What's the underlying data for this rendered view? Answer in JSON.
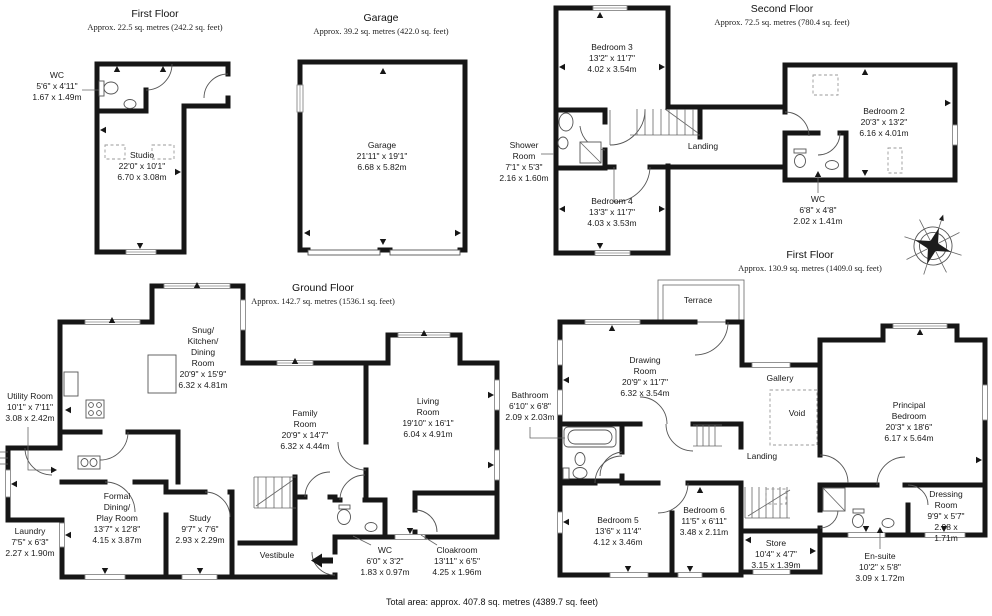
{
  "colors": {
    "wall": "#161616",
    "background": "#ffffff"
  },
  "headers": {
    "annex_first_floor": {
      "title": "First Floor",
      "subtitle": "Approx. 22.5 sq. metres (242.2 sq. feet)"
    },
    "garage": {
      "title": "Garage",
      "subtitle": "Approx. 39.2 sq. metres (422.0 sq. feet)"
    },
    "second_floor": {
      "title": "Second Floor",
      "subtitle": "Approx. 72.5 sq. metres (780.4 sq. feet)"
    },
    "ground_floor": {
      "title": "Ground Floor",
      "subtitle": "Approx. 142.7 sq. metres (1536.1 sq. feet)"
    },
    "first_floor": {
      "title": "First Floor",
      "subtitle": "Approx. 130.9 sq. metres (1409.0 sq. feet)"
    }
  },
  "rooms": {
    "wc_annex": {
      "name": "WC",
      "imperial": "5'6\" x 4'11\"",
      "metric": "1.67 x 1.49m"
    },
    "studio": {
      "name": "Studio",
      "imperial": "22'0\" x 10'1\"",
      "metric": "6.70 x 3.08m"
    },
    "garage_room": {
      "name": "Garage",
      "imperial": "21'11\" x 19'1\"",
      "metric": "6.68 x 5.82m"
    },
    "bedroom3": {
      "name": "Bedroom 3",
      "imperial": "13'2\" x 11'7\"",
      "metric": "4.02 x 3.54m"
    },
    "shower_room": {
      "name": "Shower\nRoom",
      "imperial": "7'1\" x 5'3\"",
      "metric": "2.16 x 1.60m"
    },
    "bedroom4": {
      "name": "Bedroom 4",
      "imperial": "13'3\" x 11'7\"",
      "metric": "4.03 x 3.53m"
    },
    "landing_second": {
      "name": "Landing"
    },
    "bedroom2": {
      "name": "Bedroom 2",
      "imperial": "20'3\" x 13'2\"",
      "metric": "6.16 x 4.01m"
    },
    "wc_second": {
      "name": "WC",
      "imperial": "6'8\" x 4'8\"",
      "metric": "2.02 x 1.41m"
    },
    "utility": {
      "name": "Utility Room",
      "imperial": "10'1\" x 7'11\"",
      "metric": "3.08 x 2.42m"
    },
    "snug_kitchen_dining": {
      "name": "Snug/\nKitchen/\nDining\nRoom",
      "imperial": "20'9\" x 15'9\"",
      "metric": "6.32 x 4.81m"
    },
    "family_room": {
      "name": "Family\nRoom",
      "imperial": "20'9\" x 14'7\"",
      "metric": "6.32 x 4.44m"
    },
    "living_room": {
      "name": "Living\nRoom",
      "imperial": "19'10\" x 16'1\"",
      "metric": "6.04 x 4.91m"
    },
    "formal_dining": {
      "name": "Formal\nDining/\nPlay Room",
      "imperial": "13'7\" x 12'8\"",
      "metric": "4.15 x 3.87m"
    },
    "laundry": {
      "name": "Laundry",
      "imperial": "7'5\" x 6'3\"",
      "metric": "2.27 x 1.90m"
    },
    "study": {
      "name": "Study",
      "imperial": "9'7\" x 7'6\"",
      "metric": "2.93 x 2.29m"
    },
    "vestibule": {
      "name": "Vestibule"
    },
    "wc_ground": {
      "name": "WC",
      "imperial": "6'0\" x 3'2\"",
      "metric": "1.83 x 0.97m"
    },
    "cloakroom": {
      "name": "Cloakroom",
      "imperial": "13'11\" x 6'5\"",
      "metric": "4.25 x 1.96m"
    },
    "terrace": {
      "name": "Terrace"
    },
    "drawing_room": {
      "name": "Drawing\nRoom",
      "imperial": "20'9\" x 11'7\"",
      "metric": "6.32 x 3.54m"
    },
    "bathroom": {
      "name": "Bathroom",
      "imperial": "6'10\" x 6'8\"",
      "metric": "2.09 x 2.03m"
    },
    "gallery": {
      "name": "Gallery"
    },
    "void": {
      "name": "Void"
    },
    "landing_first": {
      "name": "Landing"
    },
    "principal_bedroom": {
      "name": "Principal\nBedroom",
      "imperial": "20'3\" x 18'6\"",
      "metric": "6.17 x 5.64m"
    },
    "bedroom5": {
      "name": "Bedroom 5",
      "imperial": "13'6\" x 11'4\"",
      "metric": "4.12 x 3.46m"
    },
    "bedroom6": {
      "name": "Bedroom 6",
      "imperial": "11'5\" x 6'11\"",
      "metric": "3.48 x 2.11m"
    },
    "store": {
      "name": "Store",
      "imperial": "10'4\" x 4'7\"",
      "metric": "3.15 x 1.39m"
    },
    "ensuite": {
      "name": "En-suite",
      "imperial": "10'2\" x 5'8\"",
      "metric": "3.09 x 1.72m"
    },
    "dressing_room": {
      "name": "Dressing\nRoom",
      "imperial": "9'9\" x 5'7\"",
      "metric": "2.98 x 1.71m"
    }
  },
  "footer": {
    "total_area": "Total area: approx. 407.8 sq. metres (4389.7 sq. feet)"
  },
  "icons": {
    "compass": "compass-rose",
    "entrance": "entrance-arrow"
  }
}
